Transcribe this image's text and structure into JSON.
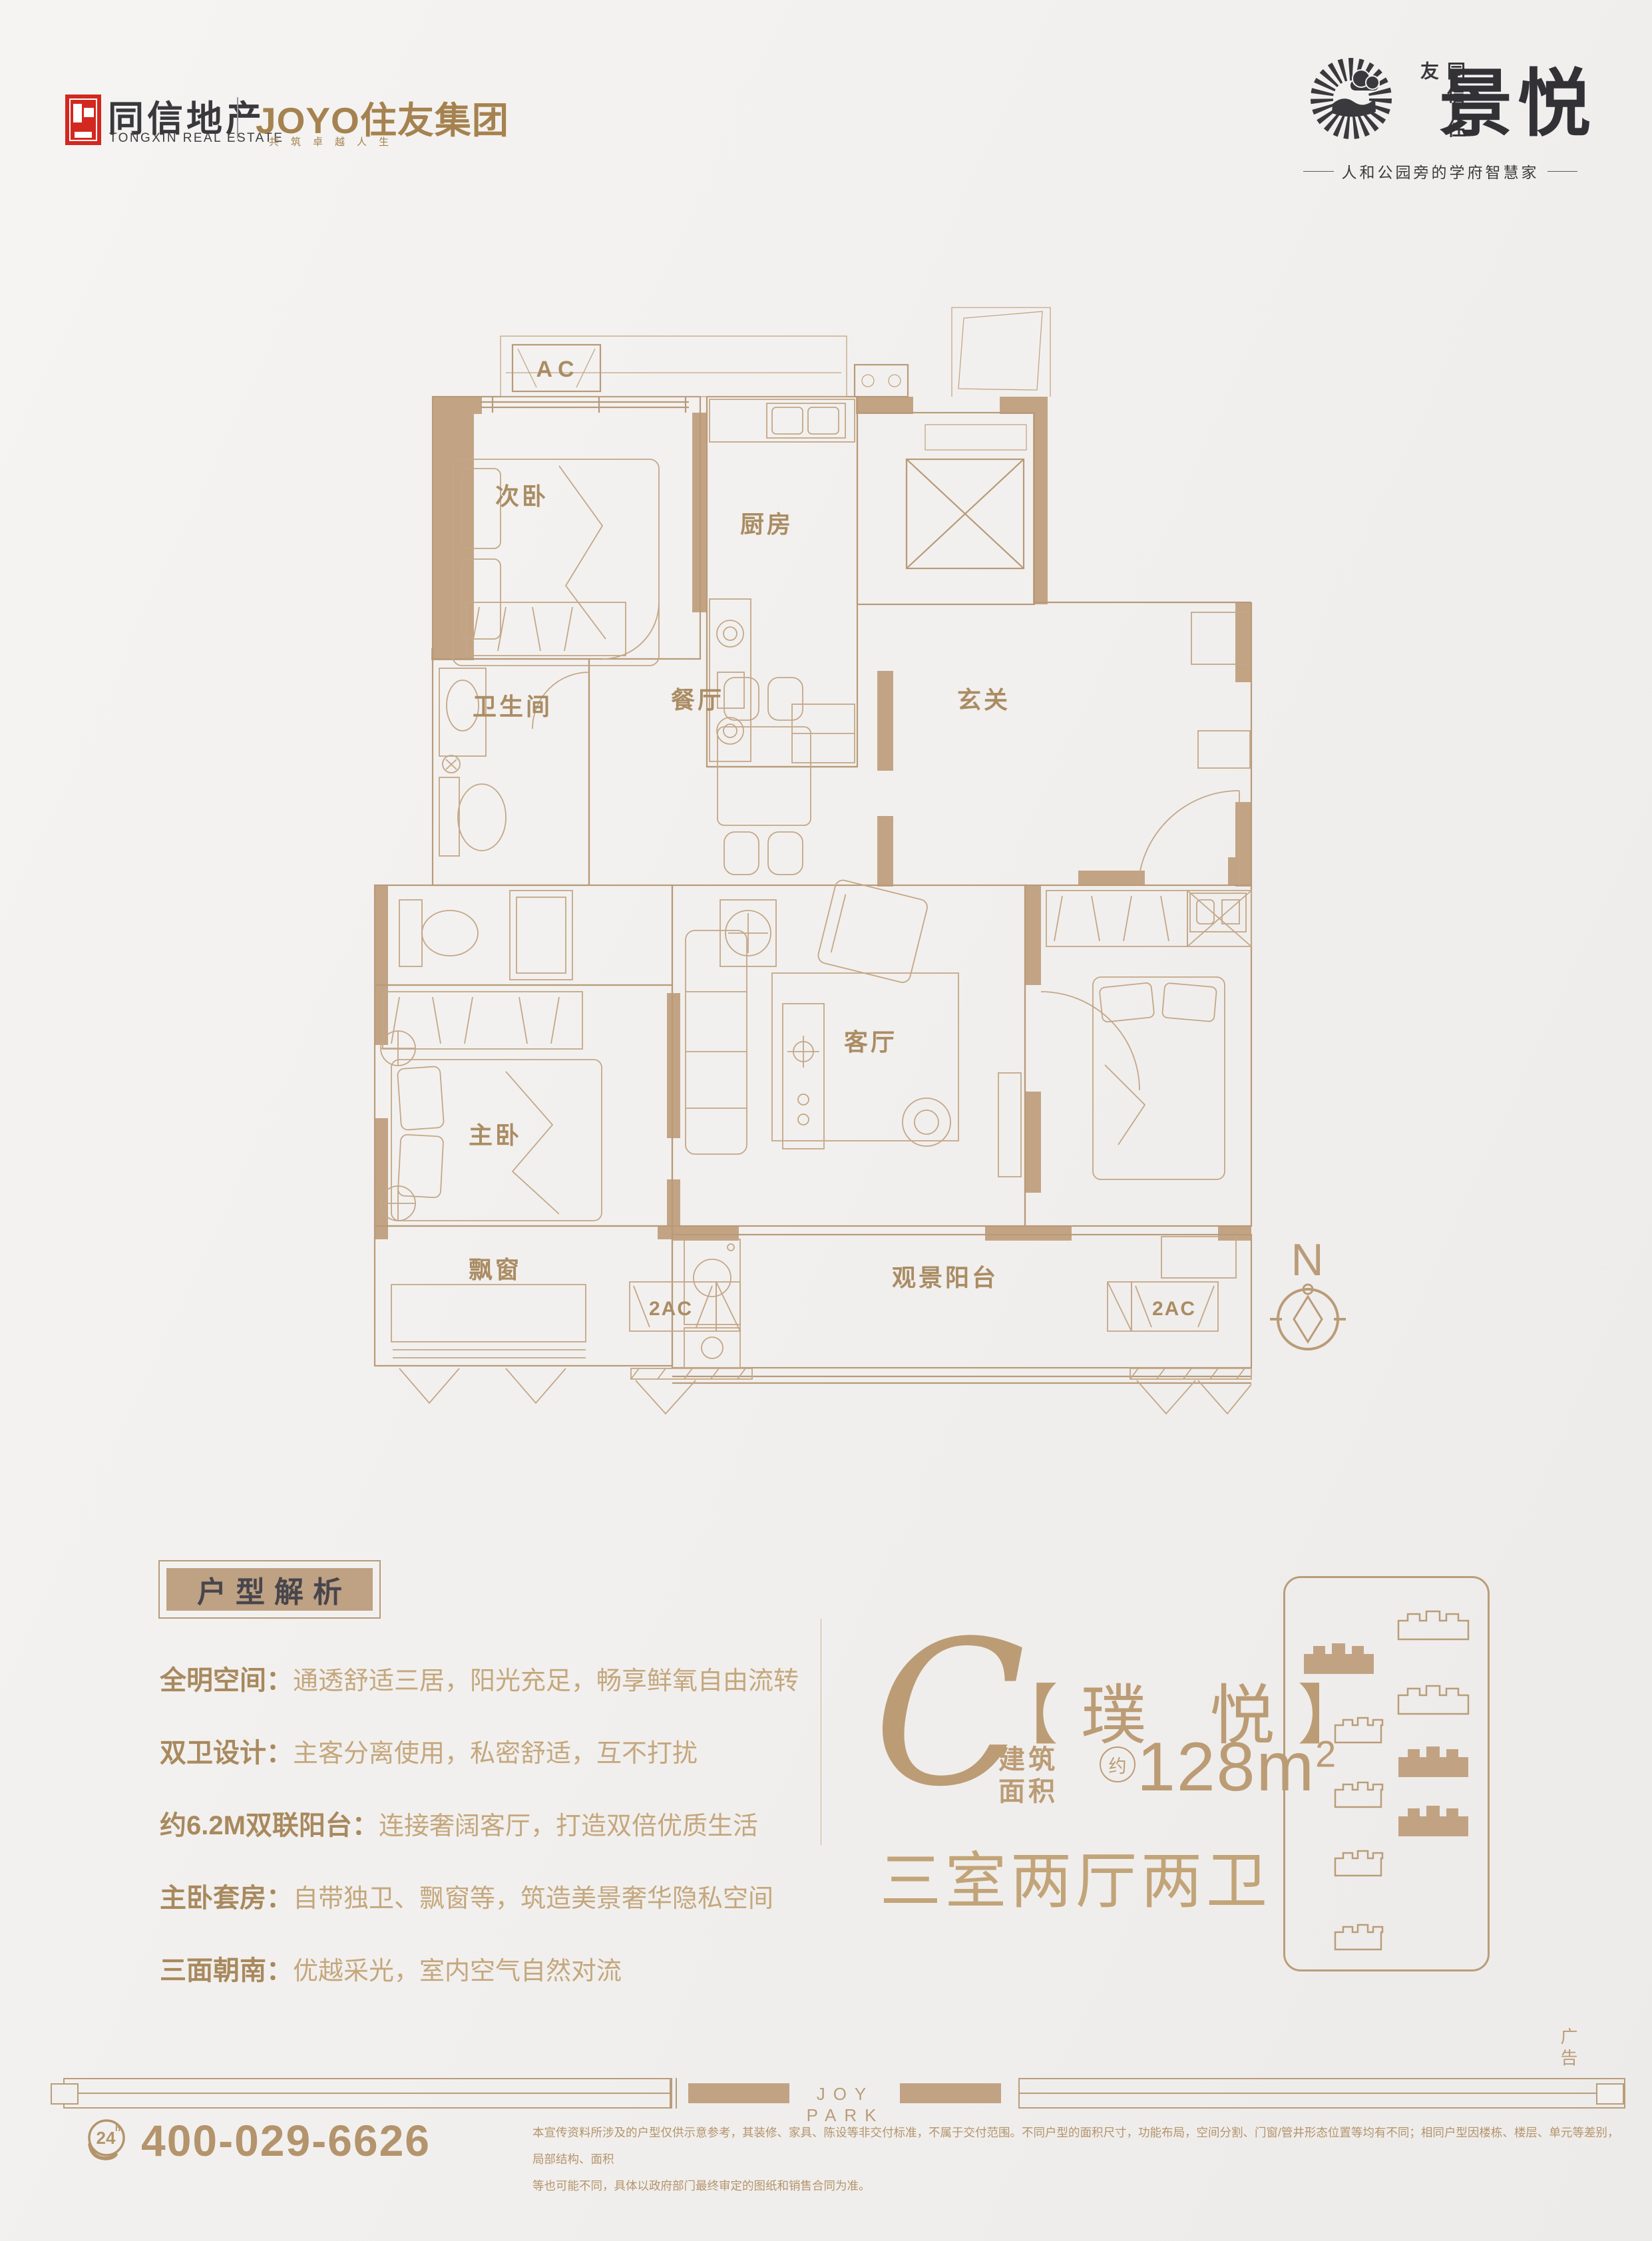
{
  "colors": {
    "accent_tan": "#bb9c75",
    "wall_fill": "#c2a485",
    "line_tan": "#b89a79",
    "logo_red": "#d3281f",
    "logo_dark": "#39383c",
    "logo_gold": "#a5824f"
  },
  "header": {
    "tongxin": {
      "name": "同信地产",
      "name_en": "TONGXIN REAL ESTATE"
    },
    "joyo": {
      "name": "JOYO住友集团",
      "slogan": "共筑卓越人生"
    },
    "project": {
      "brand_vertical": "同信·住友",
      "name": "景悦",
      "tagline": "人和公园旁的学府智慧家"
    }
  },
  "floor_plan": {
    "rooms": {
      "secondary_bedroom": "次卧",
      "kitchen": "厨房",
      "bathroom": "卫生间",
      "dining": "餐厅",
      "foyer": "玄关",
      "living": "客厅",
      "master_bedroom": "主卧",
      "bay_window": "飘窗",
      "balcony": "观景阳台"
    },
    "annotations": {
      "ac": "AC",
      "ac2_left": "2AC",
      "ac2_right": "2AC",
      "north": "N"
    }
  },
  "analysis": {
    "title": "户型解析",
    "items": [
      {
        "label": "全明空间：",
        "text": "通透舒适三居，阳光充足，畅享鲜氧自由流转"
      },
      {
        "label": "双卫设计：",
        "text": "主客分离使用，私密舒适，互不打扰"
      },
      {
        "label": "约6.2M双联阳台：",
        "text": "连接奢阔客厅，打造双倍优质生活"
      },
      {
        "label": "主卧套房：",
        "text": "自带独卫、飘窗等，筑造美景奢华隐私空间"
      },
      {
        "label": "三面朝南：",
        "text": "优越采光，室内空气自然对流"
      }
    ]
  },
  "unit": {
    "type_letter": "C",
    "type_name": "【璞 悦】",
    "area_label_1": "建筑",
    "area_label_2": "面积",
    "approx": "约",
    "area_value": "128m",
    "area_sup": "2",
    "layout": "三室两厅两卫"
  },
  "footer": {
    "joy_park": "JOY PARK",
    "ad_label": "广告",
    "phone": "400-029-6626",
    "phone_badge": "24",
    "phone_badge_sup": "h",
    "disclaimer_line1": "本宣传资料所涉及的户型仅供示意参考，其装修、家具、陈设等非交付标准，不属于交付范围。不同户型的面积尺寸，功能布局，空间分割、门窗/管井形态位置等均有不同；相同户型因楼栋、楼层、单元等差别，局部结构、面积",
    "disclaimer_line2": "等也可能不同，具体以政府部门最终审定的图纸和销售合同为准。"
  }
}
